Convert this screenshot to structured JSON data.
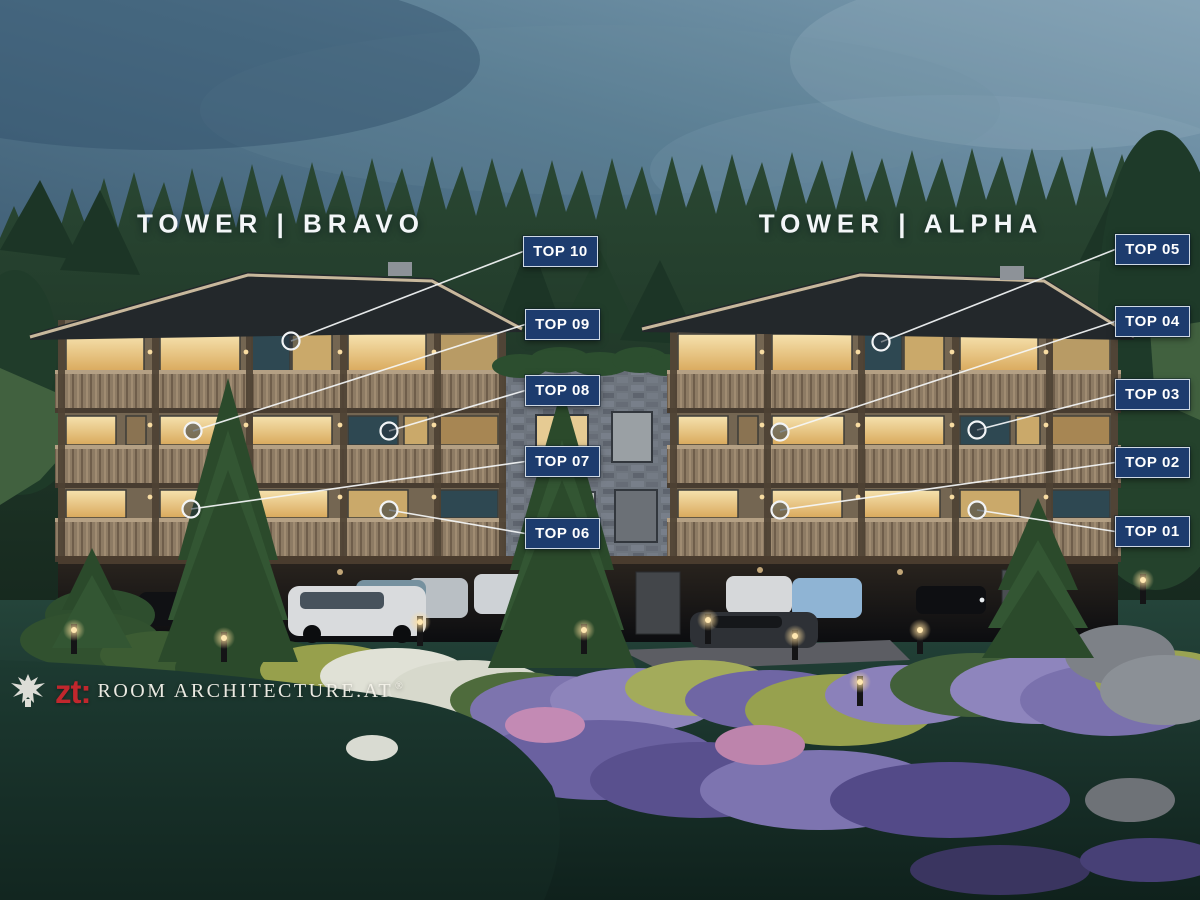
{
  "annotations": {
    "towers": [
      {
        "label": "TOWER | BRAVO",
        "x": 281,
        "y": 224
      },
      {
        "label": "TOWER | ALPHA",
        "x": 901,
        "y": 224
      }
    ],
    "badge_size": {
      "w": 75,
      "h": 31
    },
    "units": [
      {
        "label": "TOP 10",
        "badge": {
          "x": 523,
          "y": 236
        },
        "marker": {
          "x": 291,
          "y": 341
        }
      },
      {
        "label": "TOP 09",
        "badge": {
          "x": 525,
          "y": 309
        },
        "marker": {
          "x": 193,
          "y": 431
        }
      },
      {
        "label": "TOP 08",
        "badge": {
          "x": 525,
          "y": 375
        },
        "marker": {
          "x": 389,
          "y": 431
        }
      },
      {
        "label": "TOP 07",
        "badge": {
          "x": 525,
          "y": 446
        },
        "marker": {
          "x": 191,
          "y": 509
        }
      },
      {
        "label": "TOP 06",
        "badge": {
          "x": 525,
          "y": 518
        },
        "marker": {
          "x": 389,
          "y": 510
        }
      },
      {
        "label": "TOP 05",
        "badge": {
          "x": 1115,
          "y": 234
        },
        "marker": {
          "x": 881,
          "y": 342
        }
      },
      {
        "label": "TOP 04",
        "badge": {
          "x": 1115,
          "y": 306
        },
        "marker": {
          "x": 780,
          "y": 432
        }
      },
      {
        "label": "TOP 03",
        "badge": {
          "x": 1115,
          "y": 379
        },
        "marker": {
          "x": 977,
          "y": 430
        }
      },
      {
        "label": "TOP 02",
        "badge": {
          "x": 1115,
          "y": 447
        },
        "marker": {
          "x": 780,
          "y": 510
        }
      },
      {
        "label": "TOP 01",
        "badge": {
          "x": 1115,
          "y": 516
        },
        "marker": {
          "x": 977,
          "y": 510
        }
      }
    ]
  },
  "watermark": {
    "zt_label": "zt:",
    "name": "ROOM ARCHITECTURE.AT",
    "registered_mark": "®"
  },
  "colors": {
    "badge_bg": "#1d3c6e",
    "badge_border": "#cfd9e4",
    "badge_text": "#ffffff",
    "callout_line": "#f2f4f6",
    "zt_red": "#c1272d",
    "watermark_text": "#f6f3eb"
  }
}
